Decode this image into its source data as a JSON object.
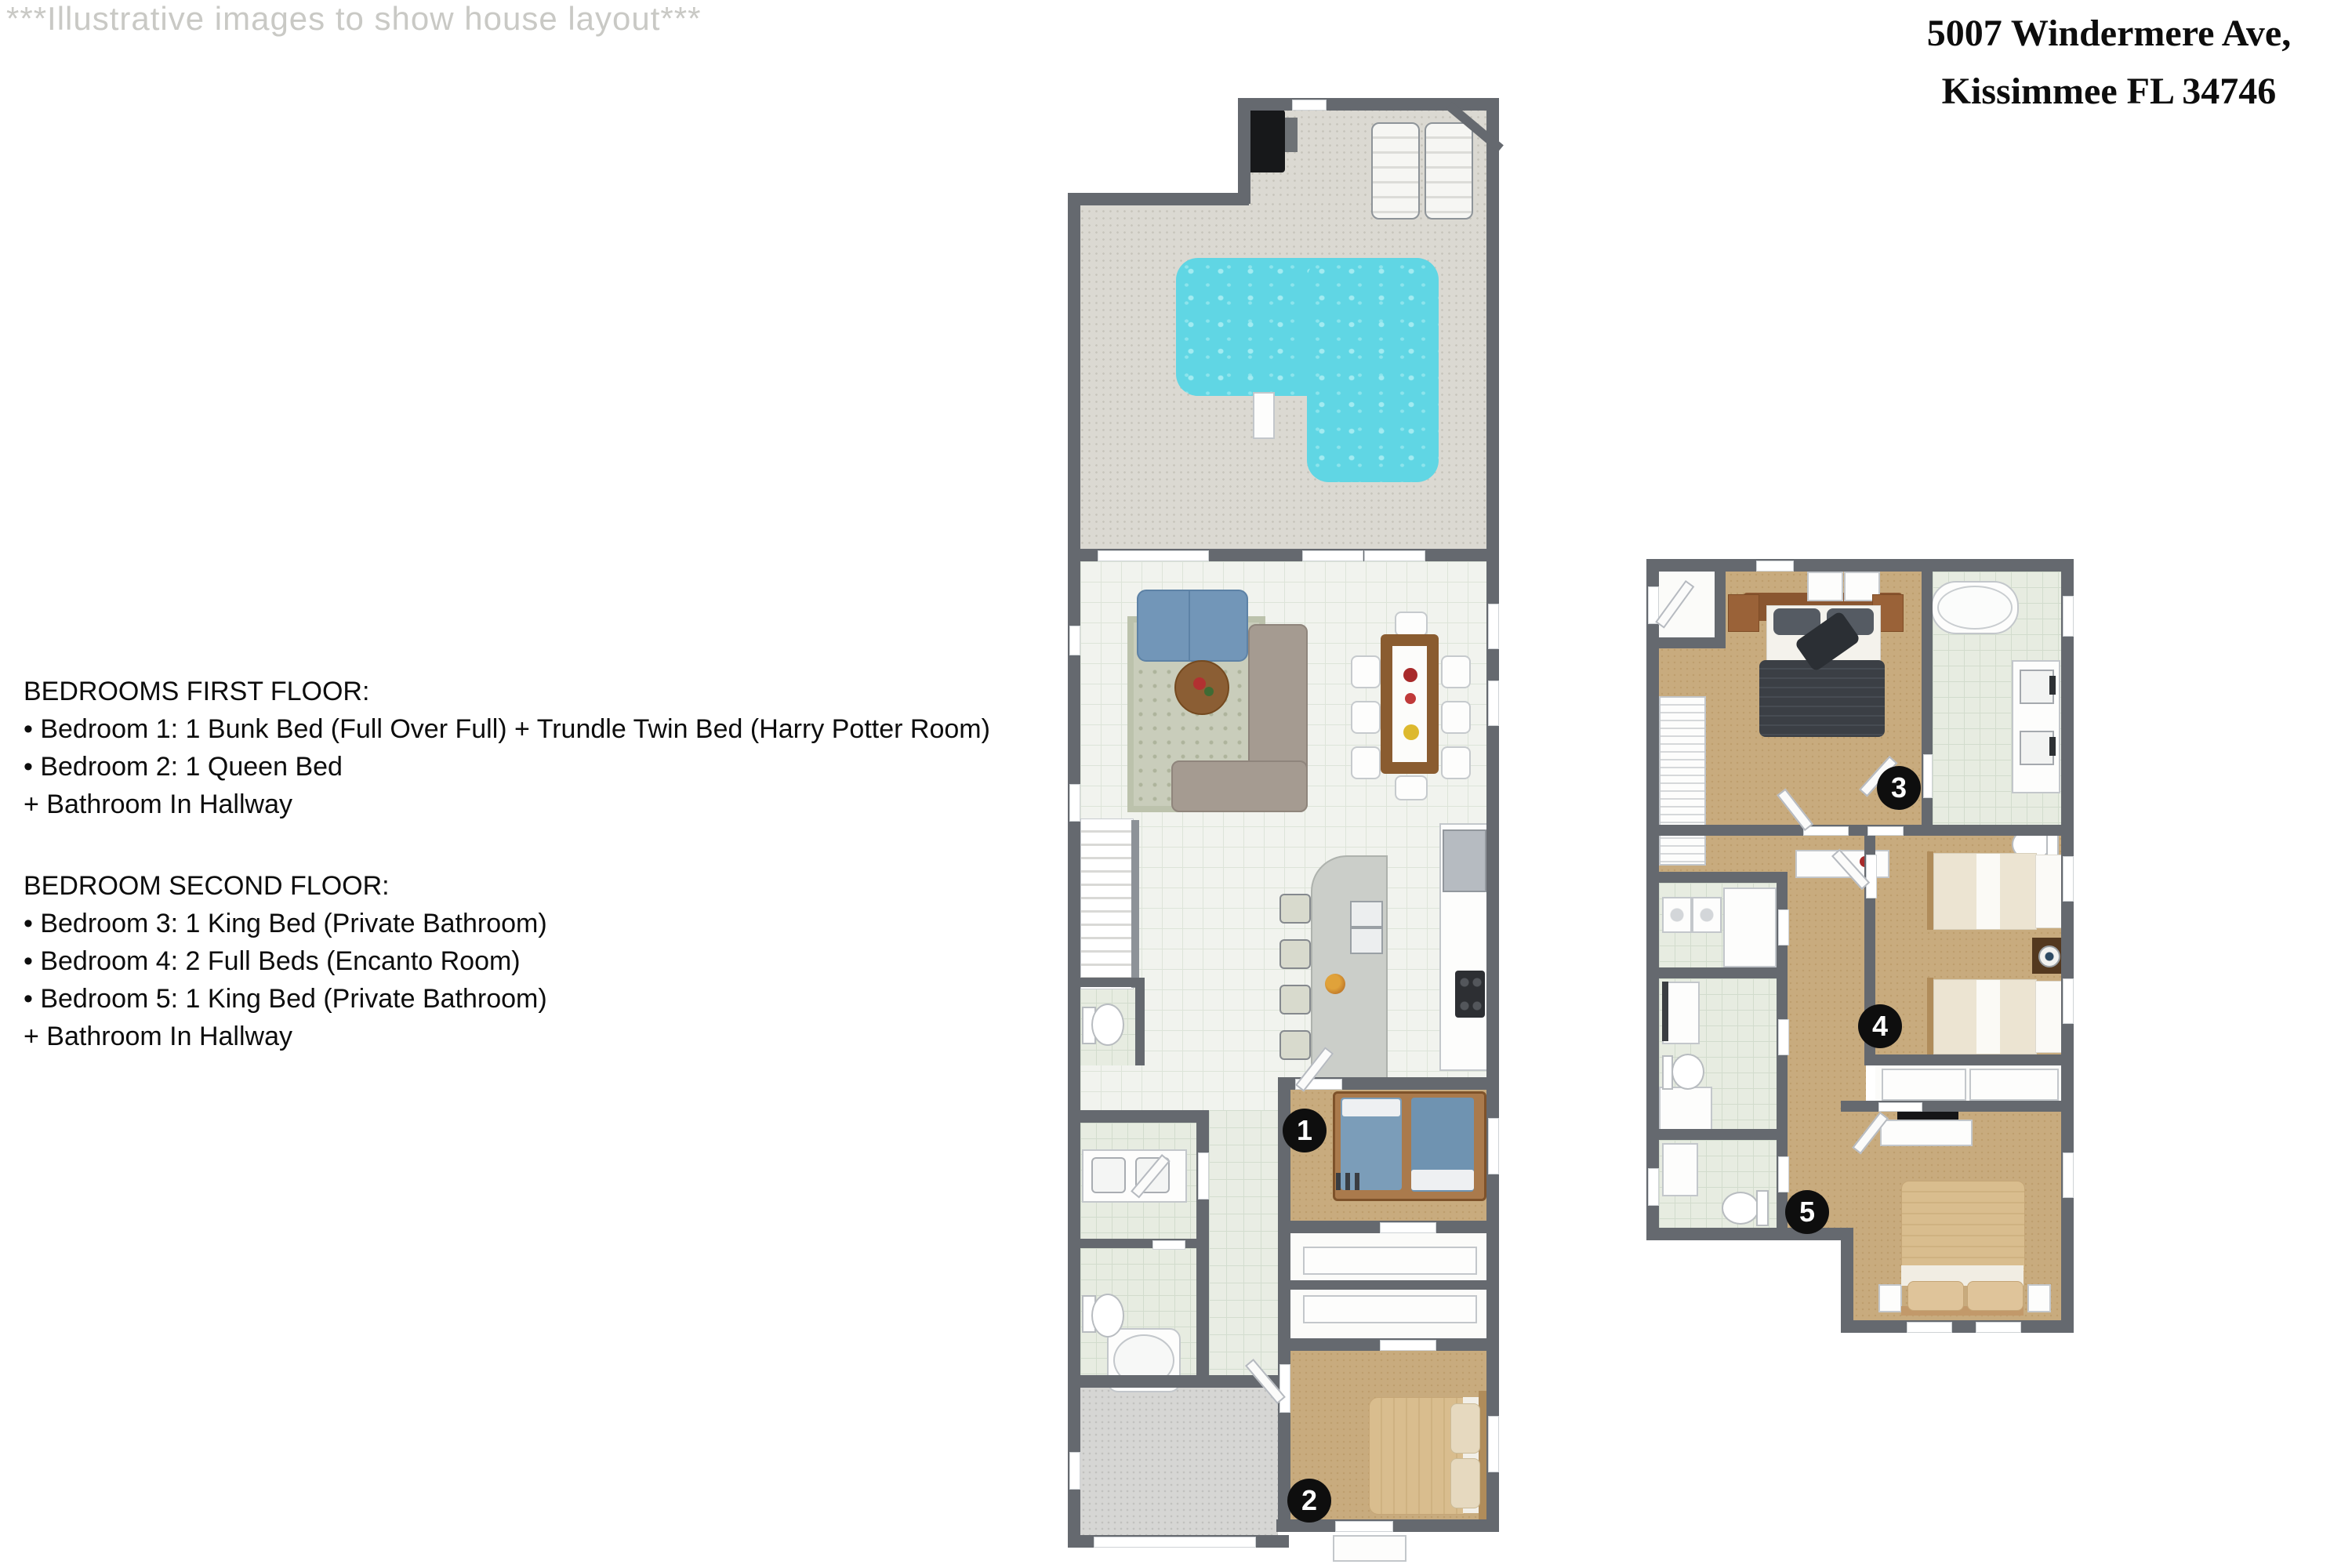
{
  "watermark": "***Illustrative images to show house layout***",
  "address": {
    "line1": "5007 Windermere Ave,",
    "line2": "Kissimmee FL 34746"
  },
  "first_floor_info": {
    "heading": "BEDROOMS FIRST FLOOR:",
    "items": [
      "• Bedroom 1: 1 Bunk Bed (Full Over Full) + Trundle Twin Bed (Harry Potter Room)",
      "• Bedroom 2: 1 Queen Bed",
      "+ Bathroom In Hallway"
    ]
  },
  "second_floor_info": {
    "heading": "BEDROOM SECOND FLOOR:",
    "items": [
      "• Bedroom 3: 1 King Bed (Private Bathroom)",
      "• Bedroom 4: 2 Full Beds (Encanto Room)",
      "• Bedroom 5: 1 King Bed (Private Bathroom)",
      "+ Bathroom In Hallway"
    ]
  },
  "badges": {
    "b1": "1",
    "b2": "2",
    "b3": "3",
    "b4": "4",
    "b5": "5"
  },
  "colors": {
    "wall": "#65696f",
    "pool_water": "#60d6e4",
    "carpet_tan": "#c8ab7e",
    "tile_white": "#f1f3ee",
    "tile_green": "#e9ede4",
    "deck_beige": "#dbd9d2",
    "sofa_blue": "#7296b8",
    "sectional_taupe": "#a59b91",
    "wood_brown": "#8a5c30",
    "badge_black": "#0e0e0e",
    "watermark_gray": "#c9c9c5"
  }
}
